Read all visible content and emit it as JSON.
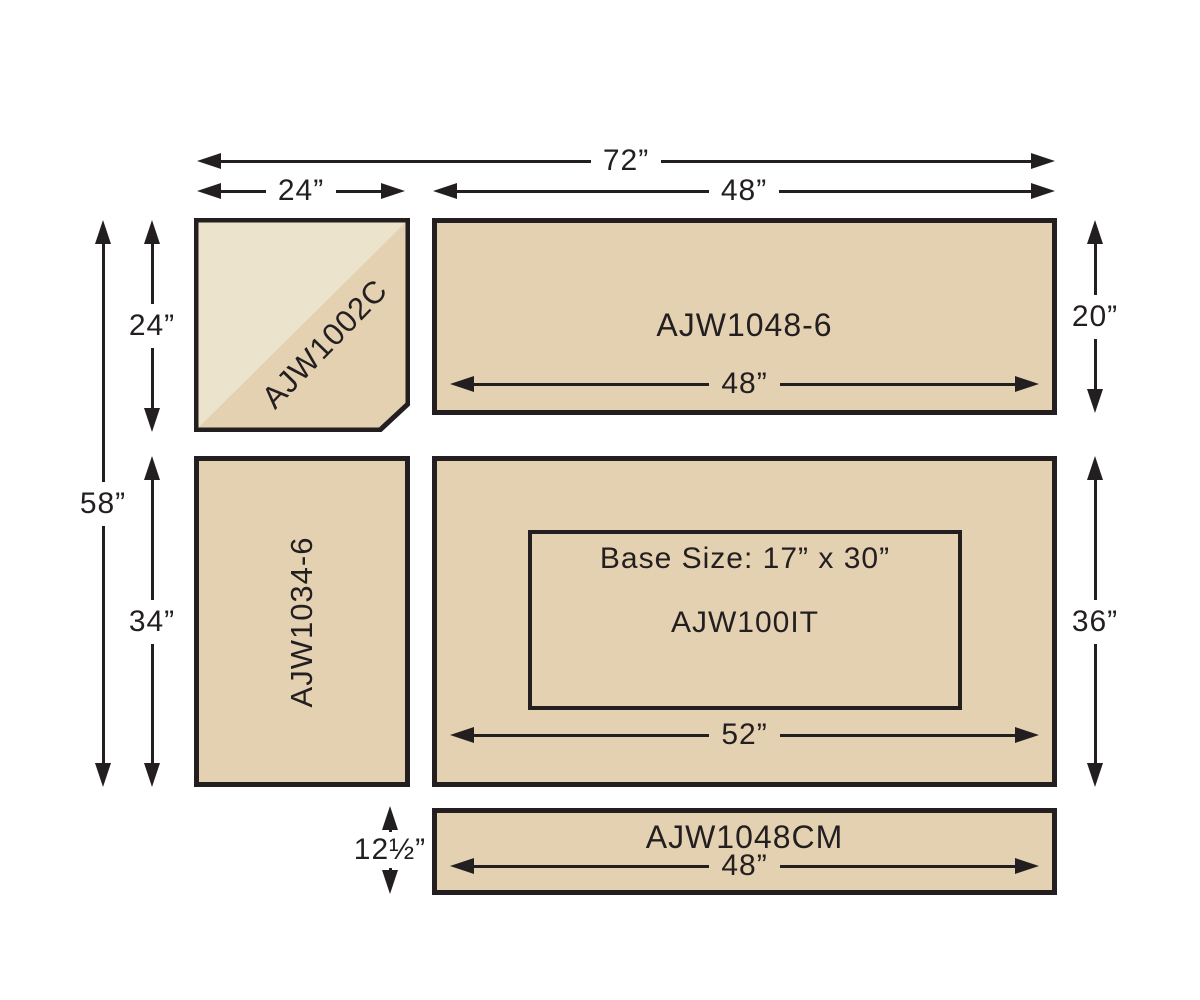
{
  "colors": {
    "surface": "#e3d1b1",
    "surface_light": "#ece3cd",
    "ink": "#231f20",
    "background": "#ffffff"
  },
  "pieces": {
    "corner": {
      "label": "AJW1002C"
    },
    "top_right": {
      "label": "AJW1048-6",
      "width_dim": "48”"
    },
    "left": {
      "label": "AJW1034-6"
    },
    "island": {
      "label": "AJW100IT",
      "base_size": "Base Size: 17” x 30”",
      "width_dim": "52”"
    },
    "mat": {
      "label": "AJW1048CM",
      "width_dim": "48”"
    }
  },
  "dimensions": {
    "overall_width": "72”",
    "corner_width": "24”",
    "right_width": "48”",
    "overall_height": "58”",
    "corner_height": "24”",
    "left_piece_height": "34”",
    "top_right_height": "20”",
    "island_height": "36”",
    "mat_height": "12½”"
  }
}
